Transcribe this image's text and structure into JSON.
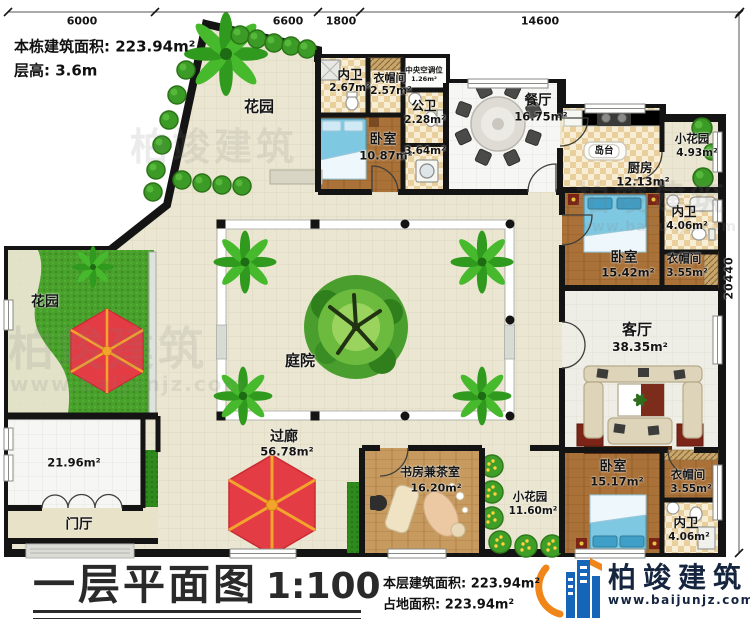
{
  "header": {
    "building_area": "本栋建筑面积: 223.94m²",
    "floor_height": "层高: 3.6m"
  },
  "dims": {
    "top1": "6000",
    "top2": "6600",
    "top3": "1800",
    "top4": "14600",
    "right": "20440"
  },
  "rooms": {
    "garden_tl": {
      "name": "花园"
    },
    "garden_left": {
      "name": "花园"
    },
    "neiwei_top": {
      "name": "内卫",
      "area": "2.67m²"
    },
    "cloak_top": {
      "name": "衣帽间",
      "area": "2.57m²"
    },
    "hvac": {
      "name": "中央空调位",
      "area": "1.26m²"
    },
    "gongwei": {
      "name": "公卫",
      "area": "2.28m²"
    },
    "bedroom_top": {
      "name": "卧室",
      "area": "10.87m²"
    },
    "hall364": {
      "area": "3.64m²"
    },
    "dining": {
      "name": "餐厅",
      "area": "16.75m²"
    },
    "island": {
      "name": "岛台"
    },
    "kitchen": {
      "name": "厨房",
      "area": "12.13m²"
    },
    "garden_tr": {
      "name": "小花园",
      "area": "4.93m²"
    },
    "neiwei_right": {
      "name": "内卫",
      "area": "4.06m²"
    },
    "bedroom_right": {
      "name": "卧室",
      "area": "15.42m²"
    },
    "cloak_right": {
      "name": "衣帽间",
      "area": "3.55m²"
    },
    "living": {
      "name": "客厅",
      "area": "38.35m²"
    },
    "courtyard": {
      "name": "庭院"
    },
    "corridor": {
      "name": "过廊",
      "area": "56.78m²"
    },
    "room_bl": {
      "area": "21.96m²"
    },
    "foyer": {
      "name": "门厅"
    },
    "study": {
      "name": "书房兼茶室",
      "area": "16.20m²"
    },
    "garden_bottom": {
      "name": "小花园",
      "area": "11.60m²"
    },
    "bedroom_br": {
      "name": "卧室",
      "area": "15.17m²"
    },
    "cloak_br": {
      "name": "衣帽间",
      "area": "3.55m²"
    },
    "neiwei_br": {
      "name": "内卫",
      "area": "4.06m²"
    }
  },
  "footer": {
    "title": "一层平面图",
    "scale": "1:100",
    "floor_area": "本层建筑面积: 223.94m²",
    "land_area": "占地面积: 223.94m²",
    "brand": "柏竣建筑",
    "site": "www.baijunjz.com"
  },
  "watermark": {
    "brand": "柏竣建筑",
    "site": "www.baijunjz.com"
  },
  "colors": {
    "wall": "#141414",
    "grass": "#49a12c",
    "umbrella_red": "#e33c45",
    "umbrella_rib": "#f2a42c",
    "bed_blue": "#7fc8e2",
    "logo_blue": "#1565b8",
    "logo_orange": "#f08519"
  }
}
